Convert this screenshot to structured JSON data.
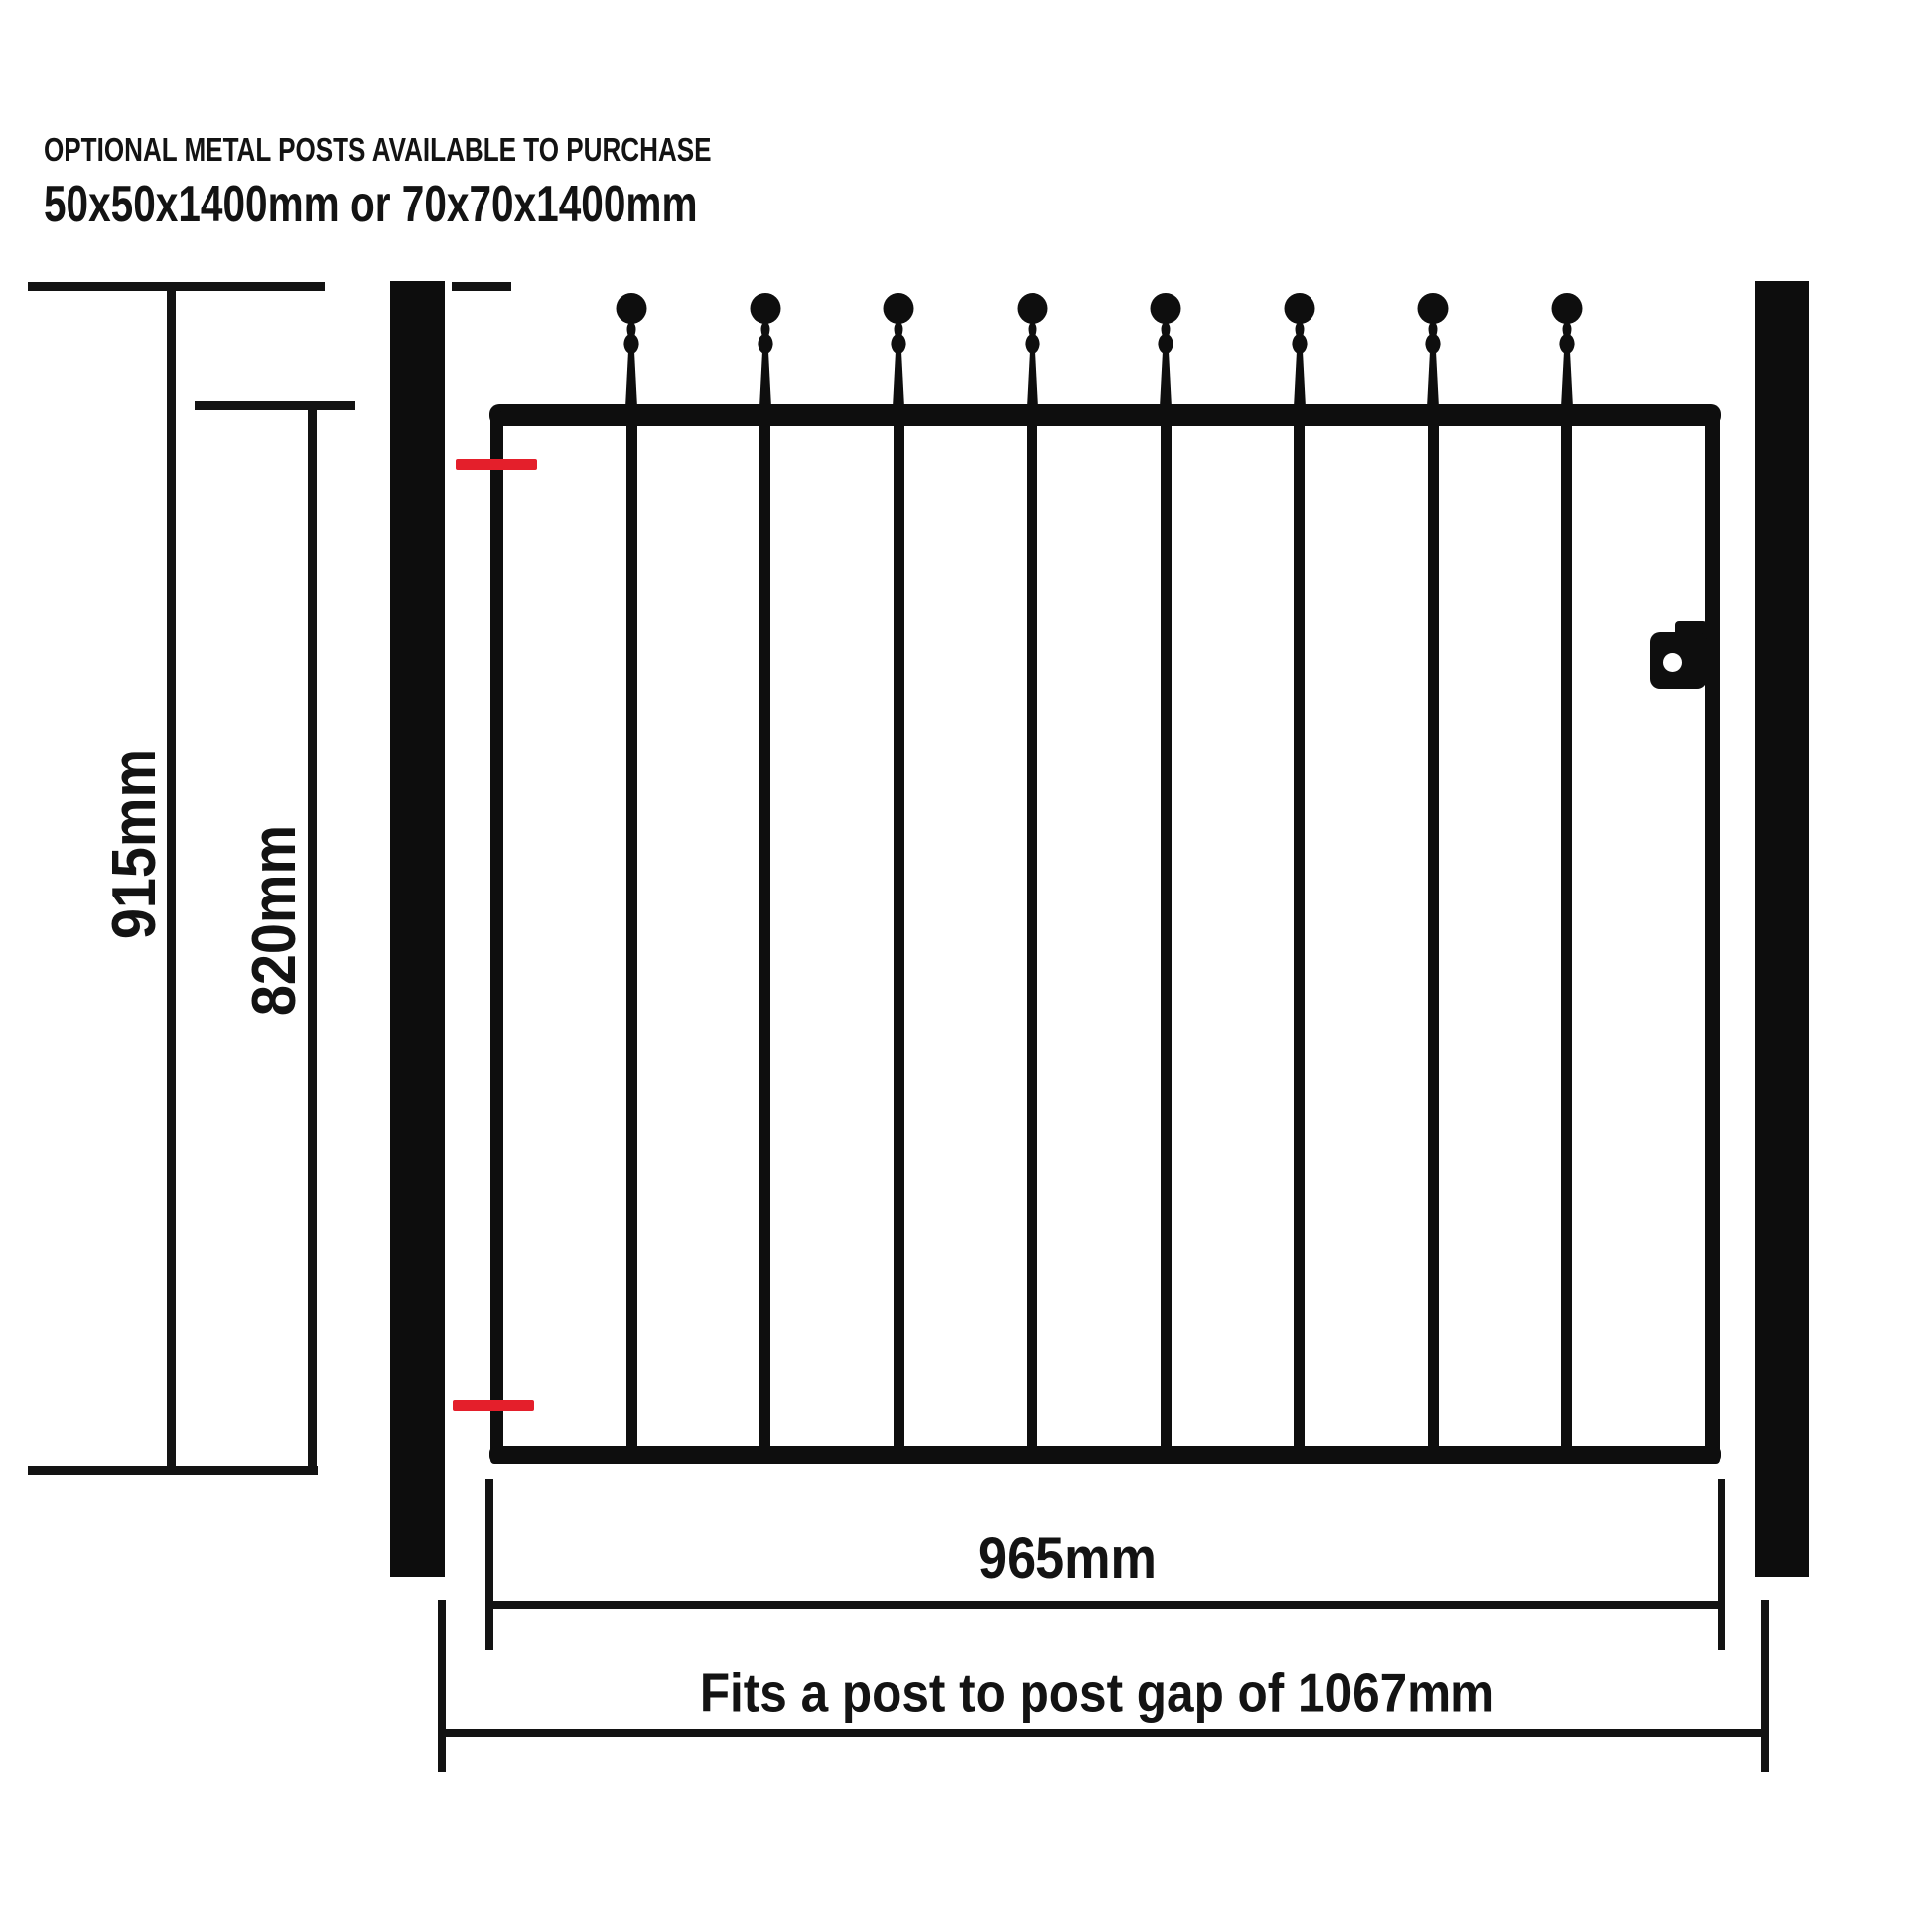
{
  "header": {
    "line1": "OPTIONAL METAL POSTS AVAILABLE TO PURCHASE",
    "line2": "50x50x1400mm or 70x70x1400mm"
  },
  "dimensions": {
    "overall_height_label": "915mm",
    "frame_height_label": "820mm",
    "gate_width_label": "965mm",
    "post_gap_label": "Fits a post to post gap of 1067mm"
  },
  "gate": {
    "finial_count": 8,
    "finial_style": "ball-top-spindle",
    "hinge_marker_count": 2,
    "latch_side": "right"
  },
  "colors": {
    "ink": "#131313",
    "metal": "#0e0e0e",
    "hinge_red": "#e41f2b",
    "background": "#ffffff"
  }
}
